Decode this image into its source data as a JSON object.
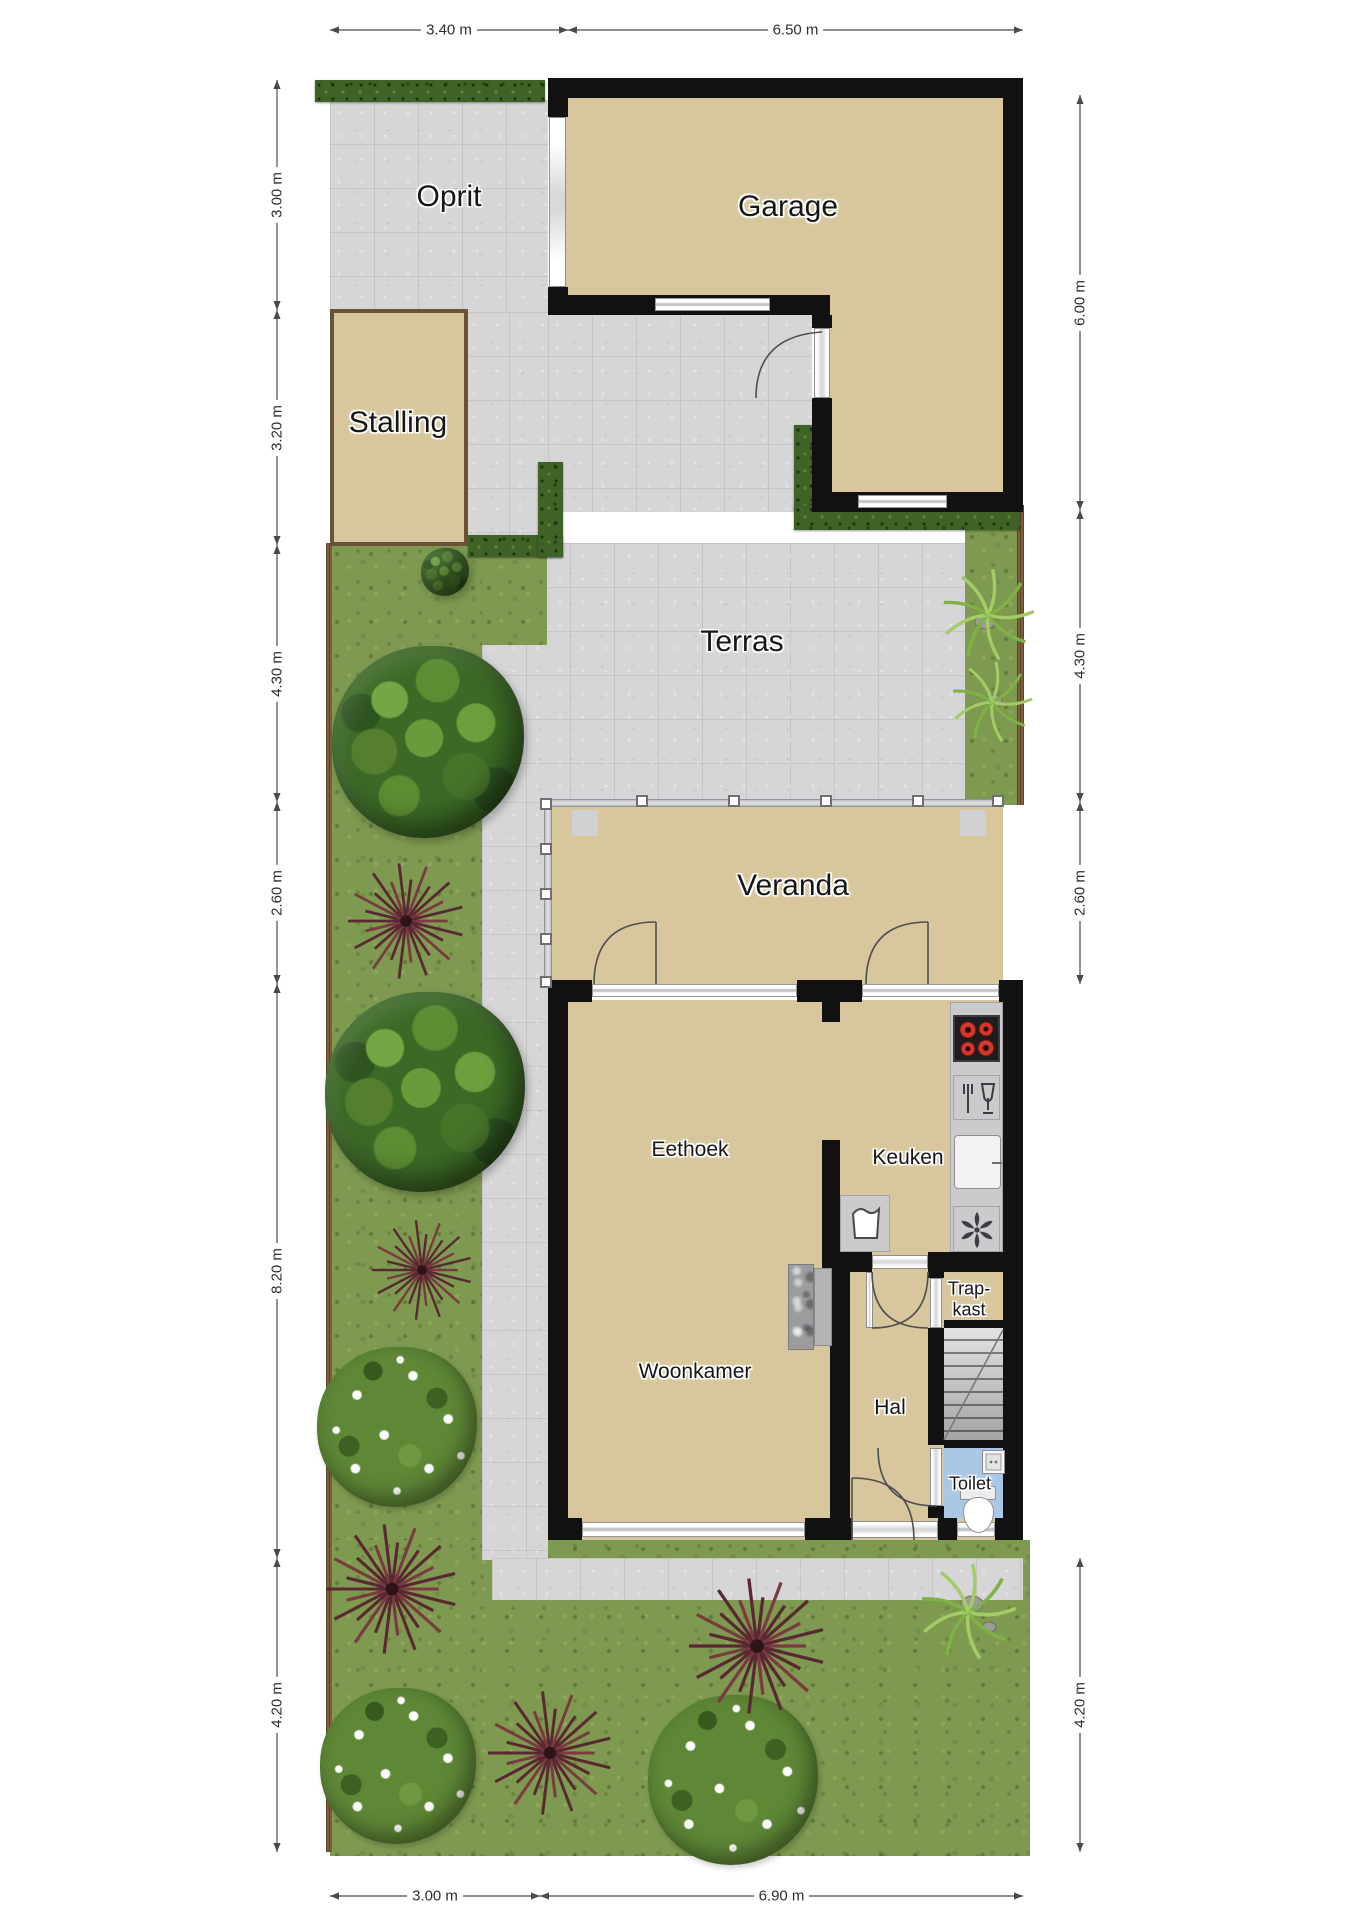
{
  "plan": {
    "type": "floorplan-site-plan",
    "floor": "begane grond met tuin"
  },
  "rooms": {
    "oprit": "Oprit",
    "garage": "Garage",
    "stalling": "Stalling",
    "terras": "Terras",
    "veranda": "Veranda",
    "eethoek": "Eethoek",
    "keuken": "Keuken",
    "woonkamer": "Woonkamer",
    "hal": "Hal",
    "trapkast_line1": "Trap-",
    "trapkast_line2": "kast",
    "toilet": "Toilet"
  },
  "dimensions": {
    "top": [
      "3.40 m",
      "6.50 m"
    ],
    "left": [
      "3.00 m",
      "3.20 m",
      "4.30 m",
      "2.60 m",
      "8.20 m",
      "4.20 m"
    ],
    "right": [
      "6.00 m",
      "4.30 m",
      "2.60 m",
      "4.20 m"
    ],
    "bottom": [
      "3.00 m",
      "6.90 m"
    ]
  },
  "icons": {
    "kitchen": [
      "stove-icon",
      "dishwasher-icon",
      "sink-icon",
      "extractor-fan-icon",
      "washing-machine-icon"
    ],
    "sanitary": [
      "toilet-icon",
      "hand-basin-icon"
    ],
    "circulation": [
      "stairs-icon"
    ],
    "garden": [
      "tree-icon",
      "spiky-plant-icon",
      "flower-bush-icon",
      "fern-icon",
      "rock-icon",
      "hedge-icon"
    ]
  },
  "colors": {
    "wall": "#111111",
    "room_fill": "#d8c79c",
    "paving": "#d6d6d8",
    "grass": "#7e9a50",
    "hedge": "#3f6226",
    "fence": "#7d5f3c",
    "stalling_border": "#6b5136",
    "toilet_floor": "#aac8e6",
    "counter": "#cbcbce",
    "burner_red": "#d2392a",
    "dimension_line": "#4a4a4a"
  }
}
